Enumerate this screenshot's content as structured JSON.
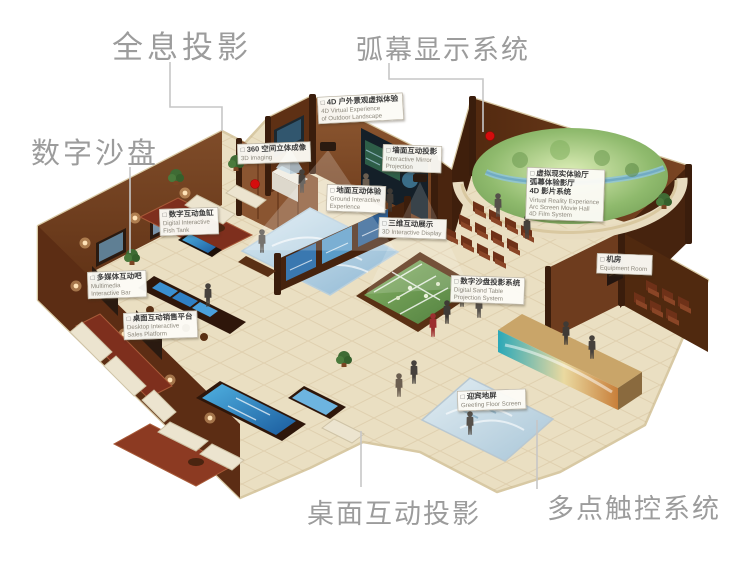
{
  "icons": {
    "checkbox": "□",
    "red_marker": "location-dot"
  },
  "colors": {
    "label_gray": "#9c9c9c",
    "red_dot": "#d40d0d",
    "wall_wood": "#6e3c1e",
    "floor_cream": "#eadfc2",
    "screen_blue": "#2f7fc4",
    "sand_green": "#6f9c54",
    "carpet_red": "#7e2f1d"
  },
  "main_labels": [
    {
      "text": "全息投影"
    },
    {
      "text": "弧幕显示系统"
    },
    {
      "text": "数字沙盘"
    },
    {
      "text": "桌面互动投影"
    },
    {
      "text": "多点触控系统"
    }
  ],
  "callouts": [
    {
      "zh": "4D 户外景观虚拟体验",
      "en": [
        "4D Virtual Experience",
        "of Outdoor Landscape"
      ]
    },
    {
      "zh": "360 空间立体成像",
      "en": [
        "3D Imaging"
      ]
    },
    {
      "zh": "墙面互动投影",
      "en": [
        "Interactive Mirror",
        "Projection"
      ]
    },
    {
      "zh_lines": [
        "虚拟现实体验厅",
        "弧幕体验影厅",
        "4D 影片系统"
      ],
      "en": [
        "Virtual Reality Experience",
        "Arc Screen Movie Hall",
        "4D Film System"
      ]
    },
    {
      "zh": "数字互动鱼缸",
      "en": [
        "Digital Interactive",
        "Fish Tank"
      ]
    },
    {
      "zh": "多媒体互动吧",
      "en": [
        "Multimedia",
        "Interactive Bar"
      ]
    },
    {
      "zh": "桌面互动销售平台",
      "en": [
        "Desktop Interactive",
        "Sales Platform"
      ]
    },
    {
      "zh": "地面互动体验",
      "en": [
        "Ground Interactive",
        "Experience"
      ]
    },
    {
      "zh": "三维互动展示",
      "en": [
        "3D Interactive Display"
      ]
    },
    {
      "zh": "数字沙盘投影系统",
      "en": [
        "Digital Sand Table",
        "Projection System"
      ]
    },
    {
      "zh": "机房",
      "en": [
        "Equipment Room"
      ]
    },
    {
      "zh": "迎宾地屏",
      "en": [
        "Greeting Floor Screen"
      ]
    }
  ]
}
